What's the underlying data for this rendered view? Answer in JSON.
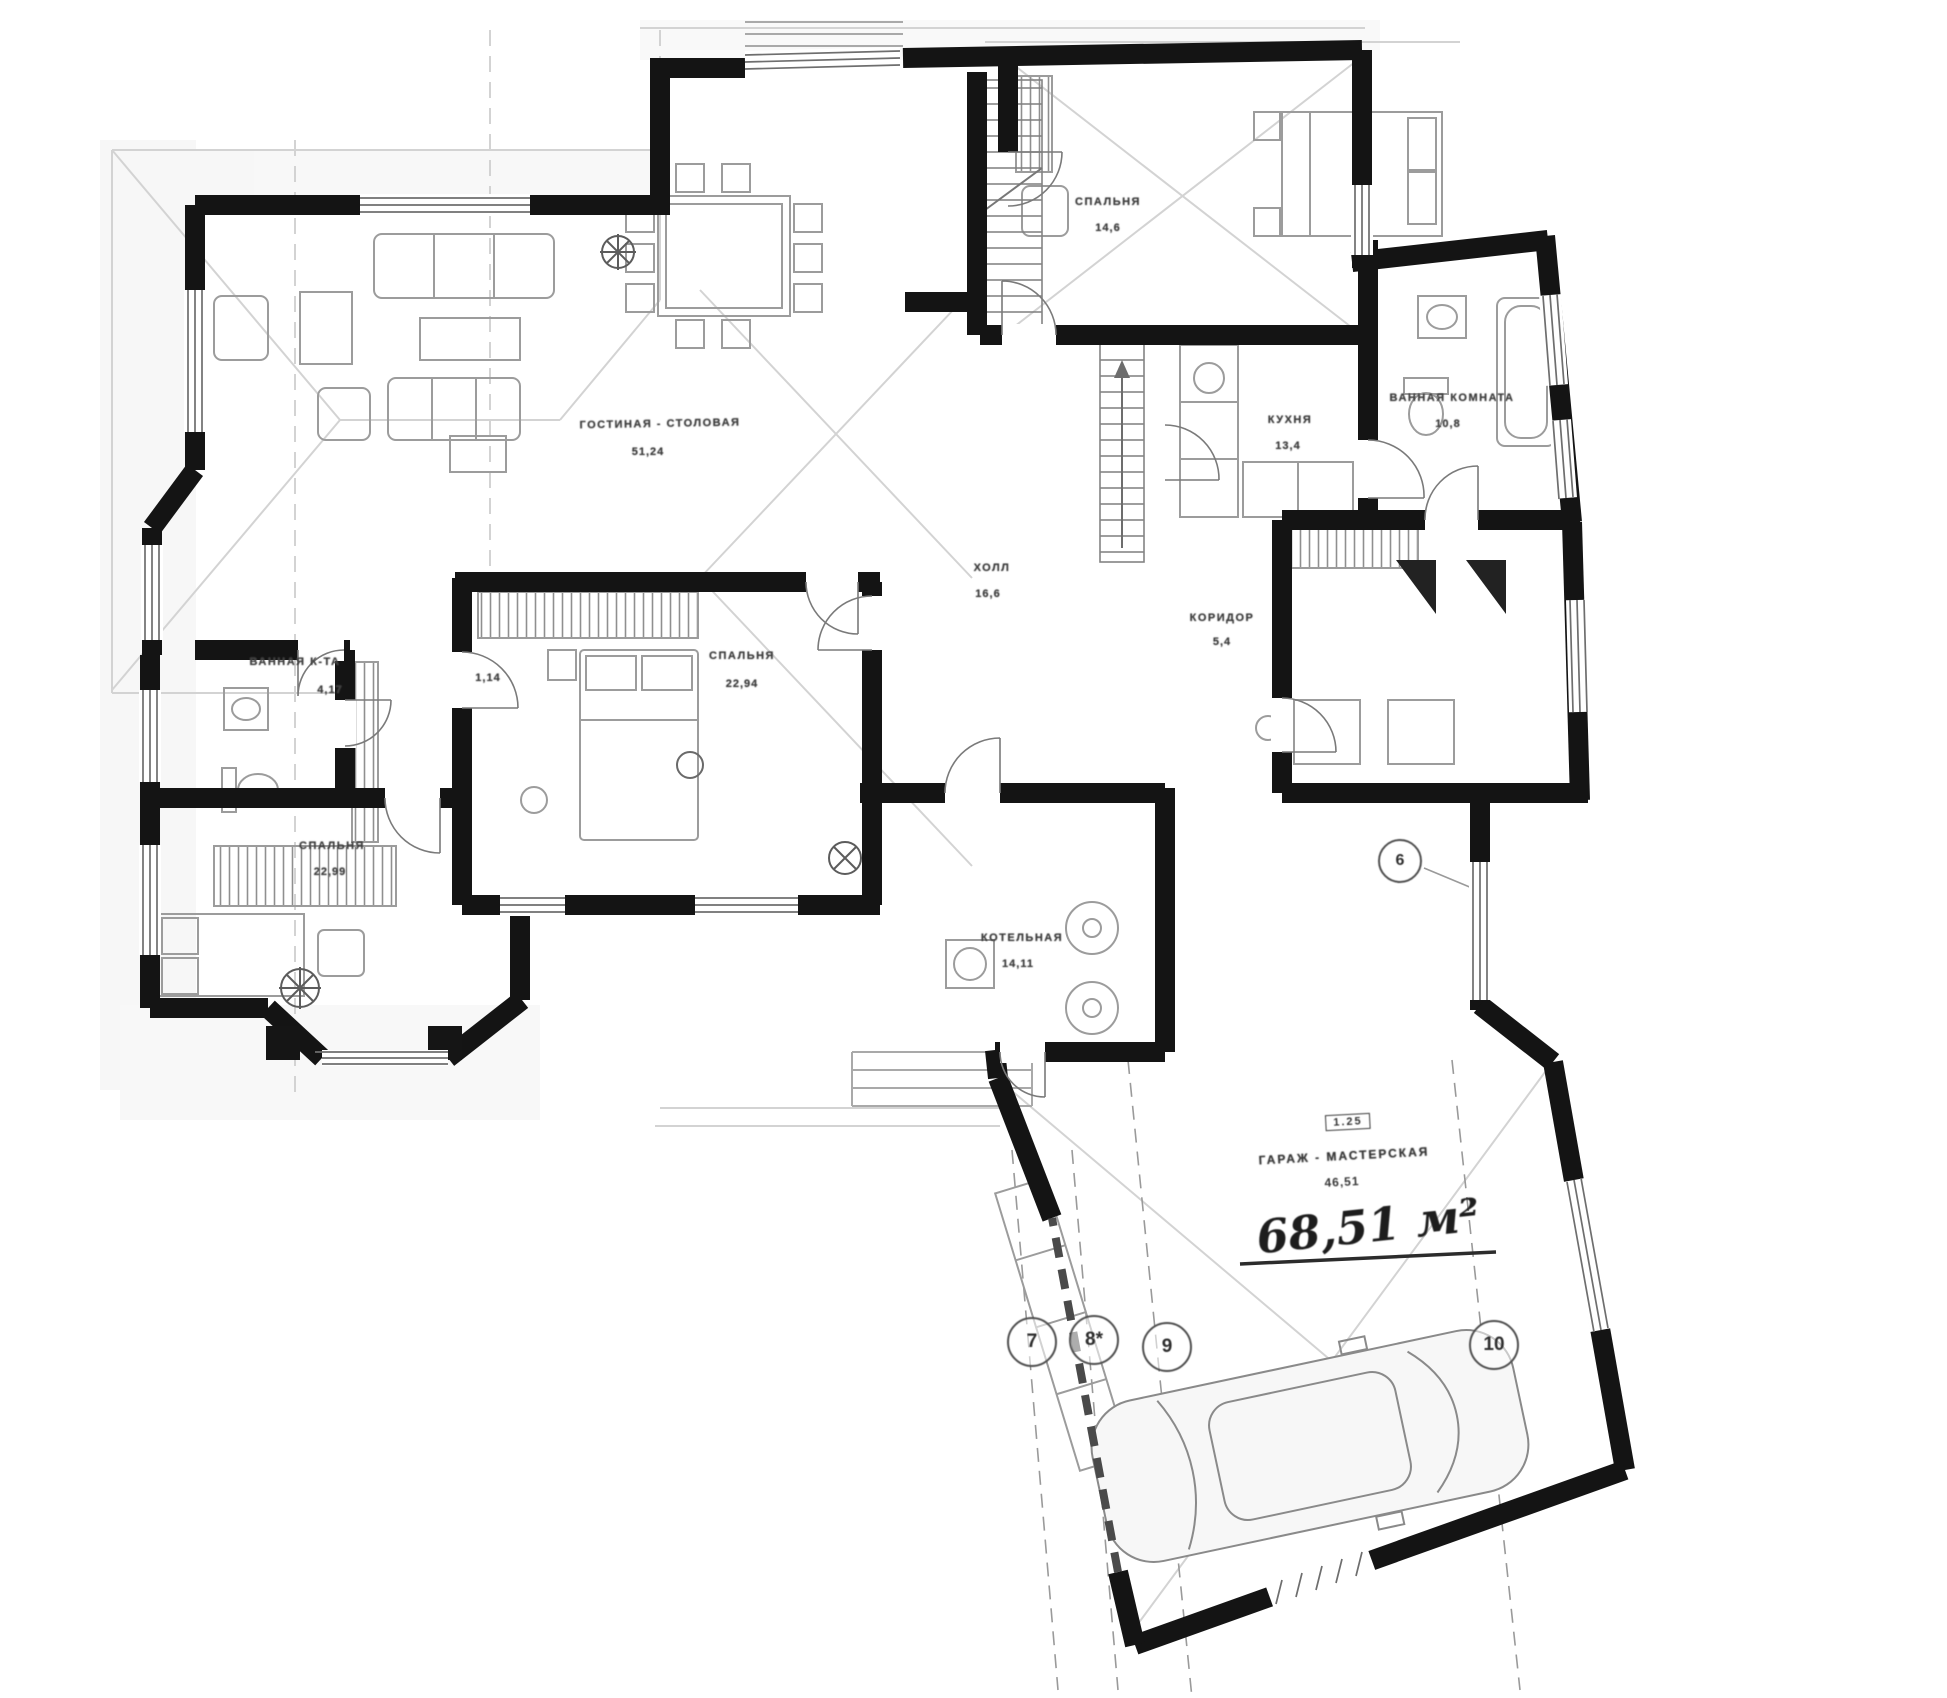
{
  "rooms": {
    "living": {
      "name": "ГОСТИНАЯ - СТОЛОВАЯ",
      "area": "51,24"
    },
    "bedroom_ne": {
      "name": "СПАЛЬНЯ",
      "area": "14,6"
    },
    "kitchen": {
      "name": "КУХНЯ",
      "area": "13,4"
    },
    "bathroom_e": {
      "name": "ВАННАЯ КОМНАТА",
      "area": "10,8"
    },
    "hall": {
      "name": "ХОЛЛ",
      "area": "16,6"
    },
    "corridor": {
      "name": "КОРИДОР",
      "area": "5,4"
    },
    "bedroom_c": {
      "name": "СПАЛЬНЯ",
      "area": "22,94"
    },
    "bathroom_w": {
      "name": "ВАННАЯ К-ТА",
      "area": "4,17"
    },
    "closet": {
      "area": "1,14"
    },
    "bedroom_sw": {
      "name": "СПАЛЬНЯ",
      "area": "22,99"
    },
    "boiler": {
      "name": "КОТЕЛЬНАЯ",
      "area": "14,11"
    },
    "garage": {
      "code": "1.25",
      "name": "ГАРАЖ - МАСТЕРСКАЯ",
      "area": "46,51",
      "area_handwritten": "68,51 м²"
    }
  },
  "axes": {
    "a7": "7",
    "a8": "8*",
    "a9": "9",
    "a10": "10",
    "a6": "6"
  }
}
